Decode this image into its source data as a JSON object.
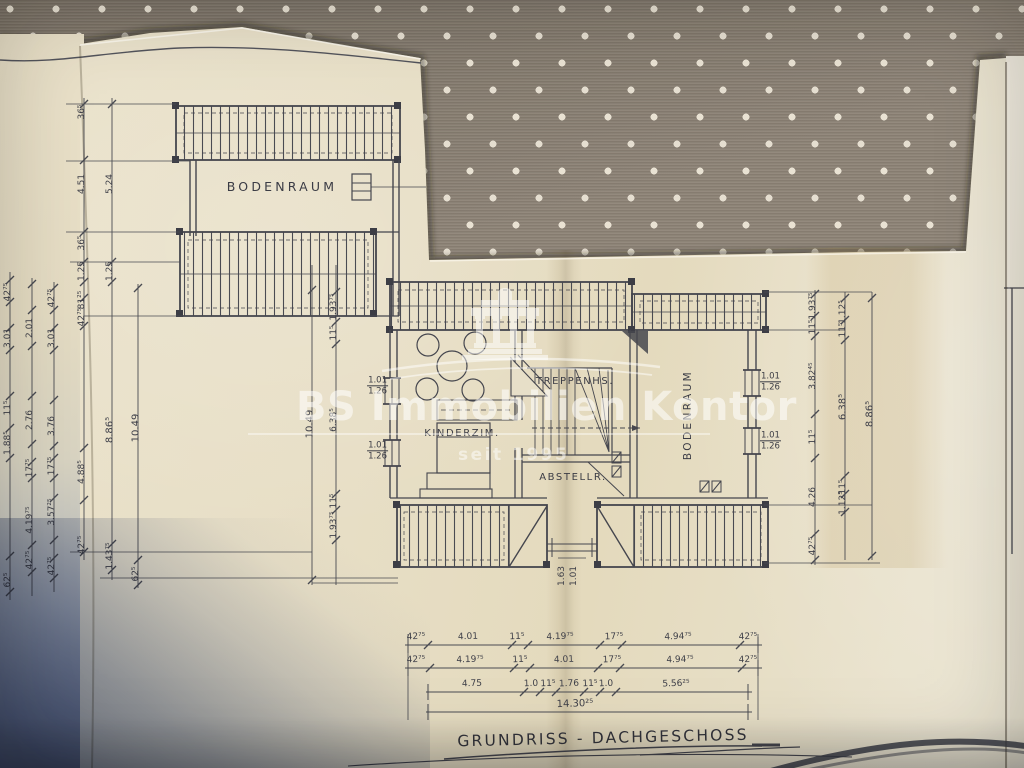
{
  "title": "GRUNDRISS - DACHGESCHOSS",
  "watermark": {
    "brand": "BS Immobilien Kontor",
    "since": "seit 1995",
    "logo": "temple-columns-icon",
    "color": "rgba(255,255,255,0.55)"
  },
  "rooms": {
    "bodenraum_top": "BODENRAUM",
    "kinderzimmer": "KINDERZIM.",
    "treppenhaus": "TREPPENHS.",
    "abstellraum": "ABSTELLR.",
    "bodenraum_right": "BODENRAUM"
  },
  "colors": {
    "paper": "#e7dfc8",
    "paper_light": "#ece6d3",
    "fabric": "#8e8477",
    "fabric_dots": "#e9e2d3",
    "ink": "#45464e",
    "shadow_blue": "#8b93a3"
  },
  "window_labels": [
    {
      "w": "1.01",
      "h": "1.26",
      "x": 388,
      "y": 386,
      "align": "right"
    },
    {
      "w": "1.01",
      "h": "1.26",
      "x": 388,
      "y": 451,
      "align": "right"
    },
    {
      "w": "1.01",
      "h": "1.26",
      "x": 760,
      "y": 382,
      "align": "left"
    },
    {
      "w": "1.01",
      "h": "1.26",
      "x": 760,
      "y": 441,
      "align": "left"
    }
  ],
  "free_labels": [
    {
      "t": "1.63",
      "x": 562,
      "y": 576,
      "r": -90
    },
    {
      "t": "1.01",
      "x": 574,
      "y": 576,
      "r": -90
    }
  ],
  "dim_chains_vertical": [
    {
      "x": 10,
      "y1": 272,
      "y2": 600,
      "ticks": [
        280,
        302,
        328,
        350,
        396,
        428,
        458,
        556,
        592
      ],
      "labels": [
        {
          "t": "42⁷⁵",
          "y": 292
        },
        {
          "t": "3.01",
          "y": 338
        },
        {
          "t": "11⁵",
          "y": 408
        },
        {
          "t": "1.88⁵",
          "y": 443
        },
        {
          "t": "62⁵",
          "y": 580
        }
      ]
    },
    {
      "x": 32,
      "y1": 278,
      "y2": 596,
      "ticks": [
        284,
        310,
        346,
        396,
        444,
        462,
        478,
        545,
        572
      ],
      "labels": [
        {
          "t": "2.01",
          "y": 328
        },
        {
          "t": "2.76",
          "y": 420
        },
        {
          "t": "17⁷⁵",
          "y": 468
        },
        {
          "t": "4.19⁷⁵",
          "y": 520
        },
        {
          "t": "42⁷⁵",
          "y": 560
        }
      ]
    },
    {
      "x": 54,
      "y1": 282,
      "y2": 592,
      "ticks": [
        288,
        310,
        328,
        350,
        400,
        446,
        458,
        478,
        498,
        540,
        558,
        578
      ],
      "labels": [
        {
          "t": "42⁷⁵",
          "y": 298
        },
        {
          "t": "3.01",
          "y": 338
        },
        {
          "t": "3.76",
          "y": 426
        },
        {
          "t": "17⁷⁵",
          "y": 466
        },
        {
          "t": "3.57²⁵",
          "y": 512
        },
        {
          "t": "42⁷⁵",
          "y": 566
        }
      ]
    },
    {
      "x": 84,
      "y1": 98,
      "y2": 560,
      "ticks": [
        104,
        160,
        232,
        262,
        282,
        298,
        326,
        448,
        500,
        552
      ],
      "labels": [
        {
          "t": "36⁵",
          "y": 112
        },
        {
          "t": "4.51",
          "y": 184
        },
        {
          "t": "36⁵",
          "y": 243
        },
        {
          "t": "1.25",
          "y": 271
        },
        {
          "t": "81²⁵",
          "y": 300
        },
        {
          "t": "42⁷⁵",
          "y": 317
        },
        {
          "t": "4.88⁵",
          "y": 472
        },
        {
          "t": "42⁷⁵",
          "y": 545
        }
      ]
    },
    {
      "x": 112,
      "y1": 98,
      "y2": 580,
      "ticks": [
        104,
        262,
        282,
        544,
        570
      ],
      "labels": [
        {
          "t": "5.24",
          "y": 184
        },
        {
          "t": "1.25",
          "y": 271
        },
        {
          "t": "8.86⁵",
          "y": 430,
          "s": 10
        },
        {
          "t": "1.43⁷⁵",
          "y": 556
        }
      ]
    },
    {
      "x": 138,
      "y1": 284,
      "y2": 588,
      "ticks": [
        288,
        560,
        585
      ],
      "labels": [
        {
          "t": "10.49",
          "y": 428,
          "s": 10
        },
        {
          "t": "62⁵",
          "y": 574
        }
      ]
    },
    {
      "x": 312,
      "y1": 265,
      "y2": 585,
      "ticks": [
        290,
        580
      ],
      "labels": [
        {
          "t": "10.49",
          "y": 424,
          "s": 10
        }
      ]
    },
    {
      "x": 336,
      "y1": 265,
      "y2": 585,
      "ticks": [
        292,
        322,
        344,
        494,
        510,
        540
      ],
      "labels": [
        {
          "t": "1.93⁷⁵",
          "y": 307
        },
        {
          "t": "11⁵",
          "y": 333
        },
        {
          "t": "6.38⁵",
          "y": 420
        },
        {
          "t": "11⁵",
          "y": 501
        },
        {
          "t": "1.93⁷⁵",
          "y": 525
        }
      ]
    },
    {
      "x": 815,
      "y1": 290,
      "y2": 565,
      "ticks": [
        294,
        316,
        336,
        414,
        458,
        534,
        560
      ],
      "labels": [
        {
          "t": "1.93⁷⁵",
          "y": 306
        },
        {
          "t": "11⁵",
          "y": 327
        },
        {
          "t": "3.82⁴⁵",
          "y": 376
        },
        {
          "t": "11⁵",
          "y": 437
        },
        {
          "t": "4.26",
          "y": 497
        },
        {
          "t": "42⁷⁵",
          "y": 546
        }
      ]
    },
    {
      "x": 845,
      "y1": 292,
      "y2": 560,
      "ticks": [
        298,
        320,
        340,
        476,
        494,
        512
      ],
      "labels": [
        {
          "t": "1.12⁵",
          "y": 312
        },
        {
          "t": "11⁵",
          "y": 330
        },
        {
          "t": "6.38⁵",
          "y": 407,
          "s": 10
        },
        {
          "t": "11⁵",
          "y": 487
        },
        {
          "t": "1.12⁵",
          "y": 503
        }
      ]
    },
    {
      "x": 872,
      "y1": 292,
      "y2": 560,
      "ticks": [
        298,
        556
      ],
      "labels": [
        {
          "t": "8.86⁵",
          "y": 414,
          "s": 10
        }
      ]
    }
  ],
  "dim_chains_horizontal": [
    {
      "y": 645,
      "x1": 405,
      "x2": 762,
      "ends": [
        408,
        758
      ],
      "ticks": [
        428,
        512,
        528,
        600,
        622,
        740
      ],
      "labels": [
        {
          "t": "42⁷⁵",
          "x": 416
        },
        {
          "t": "4.01",
          "x": 468
        },
        {
          "t": "11⁵",
          "x": 517
        },
        {
          "t": "4.19⁷⁵",
          "x": 560
        },
        {
          "t": "17⁷⁵",
          "x": 614
        },
        {
          "t": "4.94⁷⁵",
          "x": 678
        },
        {
          "t": "42⁷⁵",
          "x": 748
        }
      ]
    },
    {
      "y": 668,
      "x1": 405,
      "x2": 762,
      "ends": [
        408,
        758
      ],
      "ticks": [
        430,
        514,
        530,
        598,
        620,
        742
      ],
      "labels": [
        {
          "t": "42⁷⁵",
          "x": 416
        },
        {
          "t": "4.19⁷⁵",
          "x": 470
        },
        {
          "t": "11⁵",
          "x": 520
        },
        {
          "t": "4.01",
          "x": 564
        },
        {
          "t": "17⁷⁵",
          "x": 612
        },
        {
          "t": "4.94⁷⁵",
          "x": 680
        },
        {
          "t": "42⁷⁵",
          "x": 748
        }
      ]
    },
    {
      "y": 692,
      "x1": 426,
      "x2": 752,
      "ends": [
        428,
        748
      ],
      "ticks": [
        524,
        540,
        556,
        584,
        600,
        616
      ],
      "labels": [
        {
          "t": "4.75",
          "x": 472
        },
        {
          "t": "1.0",
          "x": 531
        },
        {
          "t": "11⁵",
          "x": 548
        },
        {
          "t": "1.76",
          "x": 569
        },
        {
          "t": "11⁵",
          "x": 590
        },
        {
          "t": "1.0",
          "x": 606
        },
        {
          "t": "5.56²⁵",
          "x": 676
        }
      ]
    },
    {
      "y": 712,
      "x1": 426,
      "x2": 752,
      "ends": [
        428,
        748
      ],
      "ticks": [],
      "labels": [
        {
          "t": "14.30²⁵",
          "x": 575,
          "s": 10
        }
      ]
    }
  ],
  "extension_lines": [
    [
      66,
      104,
      176,
      104
    ],
    [
      66,
      161,
      190,
      161
    ],
    [
      66,
      232,
      180,
      232
    ],
    [
      70,
      262,
      180,
      262
    ],
    [
      84,
      316,
      376,
      316
    ],
    [
      70,
      552,
      312,
      552
    ],
    [
      100,
      578,
      398,
      578
    ],
    [
      312,
      583,
      398,
      583
    ],
    [
      764,
      292,
      872,
      292
    ],
    [
      764,
      330,
      845,
      330
    ],
    [
      764,
      505,
      872,
      505
    ],
    [
      764,
      563,
      880,
      563
    ],
    [
      408,
      634,
      408,
      720
    ],
    [
      758,
      634,
      758,
      720
    ]
  ]
}
